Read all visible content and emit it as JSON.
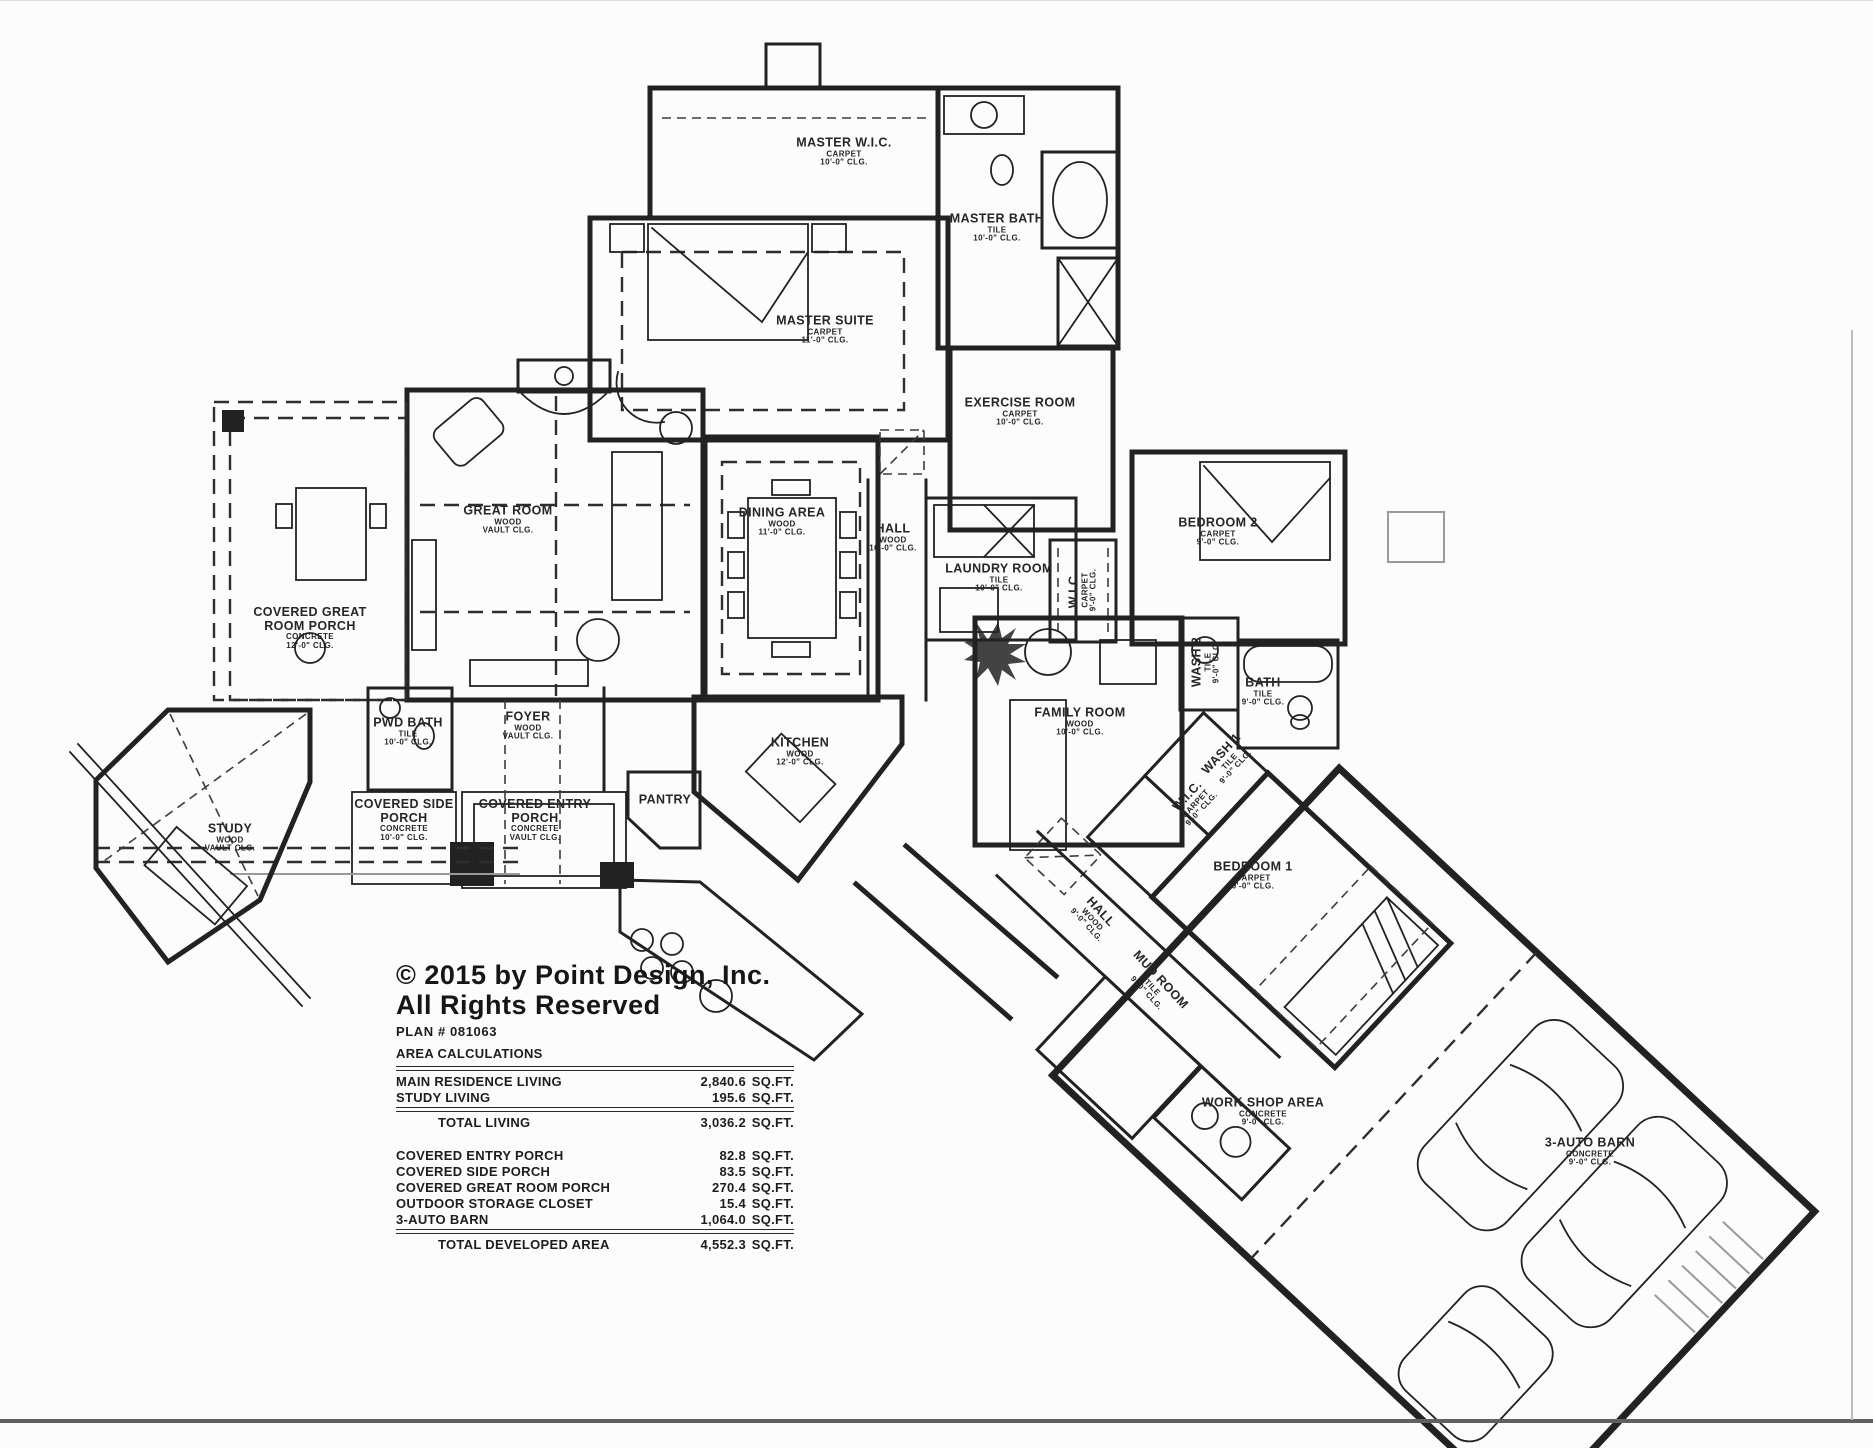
{
  "page": {
    "copyright_line1": "© 2015 by Point Design, Inc.",
    "copyright_line2": "All Rights Reserved",
    "plan_number": "PLAN # 081063"
  },
  "area_calculations": {
    "title": "AREA CALCULATIONS",
    "unit": "SQ.FT.",
    "living_rows": [
      {
        "label": "MAIN RESIDENCE LIVING",
        "value": "2,840.6"
      },
      {
        "label": "STUDY LIVING",
        "value": "195.6"
      }
    ],
    "total_living": {
      "label": "TOTAL LIVING",
      "value": "3,036.2"
    },
    "outdoor_rows": [
      {
        "label": "COVERED ENTRY PORCH",
        "value": "82.8"
      },
      {
        "label": "COVERED SIDE PORCH",
        "value": "83.5"
      },
      {
        "label": "COVERED GREAT ROOM PORCH",
        "value": "270.4"
      },
      {
        "label": "OUTDOOR STORAGE CLOSET",
        "value": "15.4"
      },
      {
        "label": "3-AUTO BARN",
        "value": "1,064.0"
      }
    ],
    "total_developed": {
      "label": "TOTAL DEVELOPED AREA",
      "value": "4,552.3"
    }
  },
  "rooms": [
    {
      "id": "master-wic",
      "name": "MASTER W.I.C.",
      "floor": "CARPET",
      "ceiling": "10'-0\" CLG.",
      "x": 844,
      "y": 152
    },
    {
      "id": "master-bath",
      "name": "MASTER BATH",
      "floor": "TILE",
      "ceiling": "10'-0\" CLG.",
      "x": 997,
      "y": 228
    },
    {
      "id": "master-suite",
      "name": "MASTER SUITE",
      "floor": "CARPET",
      "ceiling": "11'-0\" CLG.",
      "x": 825,
      "y": 330
    },
    {
      "id": "exercise-room",
      "name": "EXERCISE ROOM",
      "floor": "CARPET",
      "ceiling": "10'-0\" CLG.",
      "x": 1020,
      "y": 412
    },
    {
      "id": "great-room",
      "name": "GREAT ROOM",
      "floor": "WOOD",
      "ceiling": "VAULT CLG.",
      "x": 508,
      "y": 520
    },
    {
      "id": "dining-area",
      "name": "DINING AREA",
      "floor": "WOOD",
      "ceiling": "11'-0\" CLG.",
      "x": 782,
      "y": 522
    },
    {
      "id": "hall-main",
      "name": "HALL",
      "floor": "WOOD",
      "ceiling": "10'-0\" CLG.",
      "x": 893,
      "y": 538
    },
    {
      "id": "laundry-room",
      "name": "LAUNDRY ROOM",
      "floor": "TILE",
      "ceiling": "10'-0\" CLG.",
      "x": 999,
      "y": 578
    },
    {
      "id": "wic-hall",
      "name": "W.I.C.",
      "floor": "CARPET",
      "ceiling": "9'-0\" CLG.",
      "x": 1083,
      "y": 590,
      "rotate": -90
    },
    {
      "id": "bedroom-2",
      "name": "BEDROOM 2",
      "floor": "CARPET",
      "ceiling": "9'-0\" CLG.",
      "x": 1218,
      "y": 532
    },
    {
      "id": "covered-great-room-porch",
      "name": "COVERED GREAT ROOM PORCH",
      "floor": "CONCRETE",
      "ceiling": "12'-0\" CLG.",
      "x": 310,
      "y": 628
    },
    {
      "id": "pwd-bath",
      "name": "PWD BATH",
      "floor": "TILE",
      "ceiling": "10'-0\" CLG.",
      "x": 408,
      "y": 732
    },
    {
      "id": "wash-2",
      "name": "WASH 2",
      "floor": "TILE",
      "ceiling": "9'-0\" CLG.",
      "x": 1206,
      "y": 662,
      "rotate": -90
    },
    {
      "id": "bath",
      "name": "BATH",
      "floor": "TILE",
      "ceiling": "9'-0\" CLG.",
      "x": 1263,
      "y": 692
    },
    {
      "id": "family-room",
      "name": "FAMILY ROOM",
      "floor": "WOOD",
      "ceiling": "10'-0\" CLG.",
      "x": 1080,
      "y": 722
    },
    {
      "id": "wash-1",
      "name": "WASH 1",
      "floor": "TILE",
      "ceiling": "9'-0\" CLG.",
      "x": 1228,
      "y": 760,
      "rotate": -47
    },
    {
      "id": "wic-family",
      "name": "W.I.C.",
      "floor": "CARPET",
      "ceiling": "9'-0\" CLG.",
      "x": 1194,
      "y": 802,
      "rotate": -47
    },
    {
      "id": "study",
      "name": "STUDY",
      "floor": "WOOD",
      "ceiling": "VAULT CLG.",
      "x": 230,
      "y": 838
    },
    {
      "id": "covered-side-porch",
      "name": "COVERED SIDE PORCH",
      "floor": "CONCRETE",
      "ceiling": "10'-0\" CLG.",
      "x": 404,
      "y": 820
    },
    {
      "id": "covered-entry-porch",
      "name": "COVERED ENTRY PORCH",
      "floor": "CONCRETE",
      "ceiling": "VAULT CLG.",
      "x": 535,
      "y": 820
    },
    {
      "id": "foyer",
      "name": "FOYER",
      "floor": "WOOD",
      "ceiling": "VAULT CLG.",
      "x": 528,
      "y": 726
    },
    {
      "id": "pantry",
      "name": "PANTRY",
      "x": 665,
      "y": 800
    },
    {
      "id": "kitchen",
      "name": "KITCHEN",
      "floor": "WOOD",
      "ceiling": "12'-0\" CLG.",
      "x": 800,
      "y": 752
    },
    {
      "id": "bedroom-1",
      "name": "BEDROOM 1",
      "floor": "CARPET",
      "ceiling": "9'-0\" CLG.",
      "x": 1253,
      "y": 876
    },
    {
      "id": "hall-wing",
      "name": "HALL",
      "floor": "WOOD",
      "ceiling": "9'-0\" CLG.",
      "x": 1094,
      "y": 918,
      "rotate": 47
    },
    {
      "id": "mud-room",
      "name": "MUD ROOM",
      "floor": "TILE",
      "ceiling": "9'-0\" CLG.",
      "x": 1154,
      "y": 986,
      "rotate": 47
    },
    {
      "id": "work-shop-area",
      "name": "WORK SHOP AREA",
      "floor": "CONCRETE",
      "ceiling": "9'-0\" CLG.",
      "x": 1263,
      "y": 1112
    },
    {
      "id": "auto-barn",
      "name": "3-AUTO BARN",
      "floor": "CONCRETE",
      "ceiling": "9'-0\" CLG.",
      "x": 1590,
      "y": 1152
    }
  ]
}
